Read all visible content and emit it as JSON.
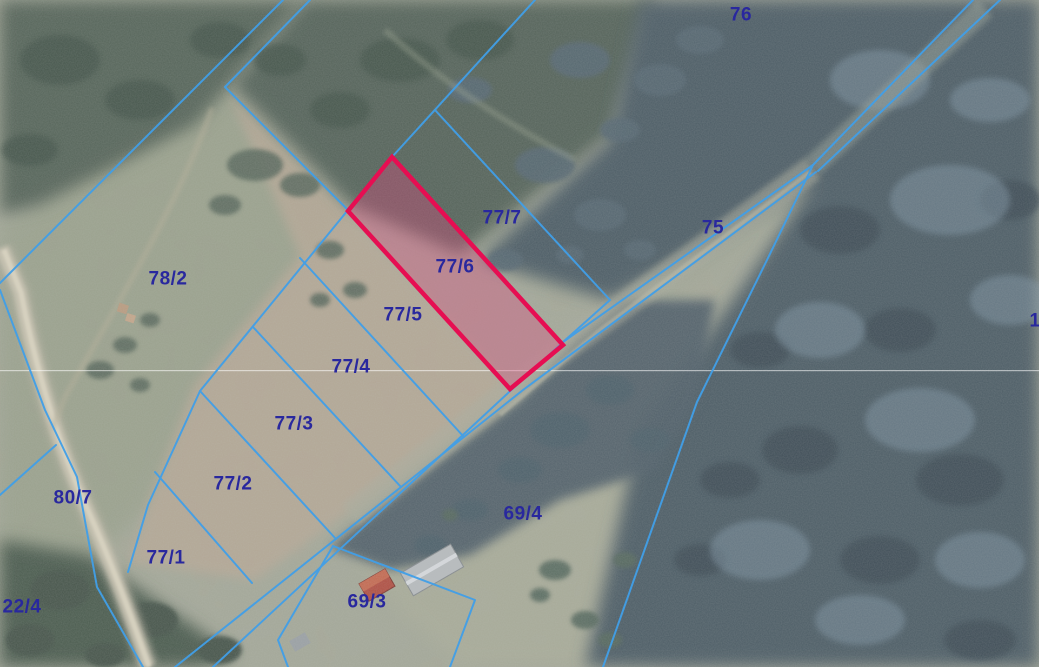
{
  "map": {
    "view_label": "cadastral-aerial-view",
    "highlighted_parcel": "77/6",
    "colors": {
      "boundary_line": "#419fe8",
      "highlight_outline": "#e60e52",
      "highlight_fill": "rgba(226,70,125,0.34)",
      "parcel_label": "#29289e",
      "seam_line": "rgba(255,255,255,0.55)"
    },
    "parcels": [
      {
        "text": "76"
      },
      {
        "text": "75"
      },
      {
        "text": "77/7"
      },
      {
        "text": "77/6",
        "highlighted": true
      },
      {
        "text": "77/5"
      },
      {
        "text": "77/4"
      },
      {
        "text": "77/3"
      },
      {
        "text": "77/2"
      },
      {
        "text": "77/1"
      },
      {
        "text": "78/2"
      },
      {
        "text": "80/7"
      },
      {
        "text": "22/4"
      },
      {
        "text": "69/4"
      },
      {
        "text": "69/3"
      },
      {
        "text": "1"
      }
    ]
  }
}
